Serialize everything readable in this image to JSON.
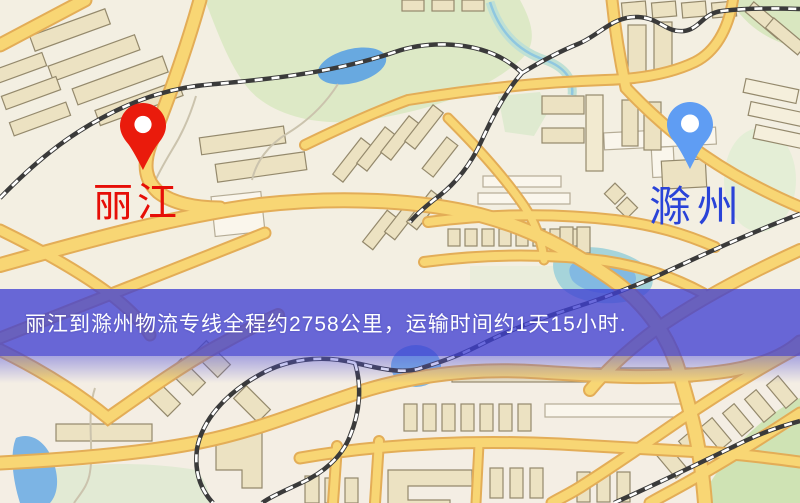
{
  "window": {
    "width": 800,
    "height": 503,
    "type": "logistics-route-map"
  },
  "map": {
    "markers": [
      {
        "id": "origin",
        "label": "丽江",
        "pin_color": "#ea1b0c",
        "label_color": "#e60e07",
        "pin_style": "red-teardrop-marker"
      },
      {
        "id": "destination",
        "label": "滁州",
        "pin_color": "#5f9df3",
        "label_color": "#2a43d8",
        "pin_style": "blue-teardrop-marker"
      }
    ],
    "banner": {
      "text": "丽江到滁州物流专线全程约2758公里，运输时间约1天15小时.",
      "background": "#4040d2",
      "opacity": 0.78,
      "text_color": "#ffffff",
      "distance_km": "2758",
      "duration": "1天15小时"
    },
    "colors": {
      "background": "#f3efe2",
      "road_fill": "#f8d674",
      "road_casing": "#e3ad57",
      "water": "#7cb4e4",
      "park_green": "#dde9c6",
      "railway": "#3a3a3a",
      "building_tan": "#ece2c2",
      "building_white": "#faf6ec"
    }
  }
}
